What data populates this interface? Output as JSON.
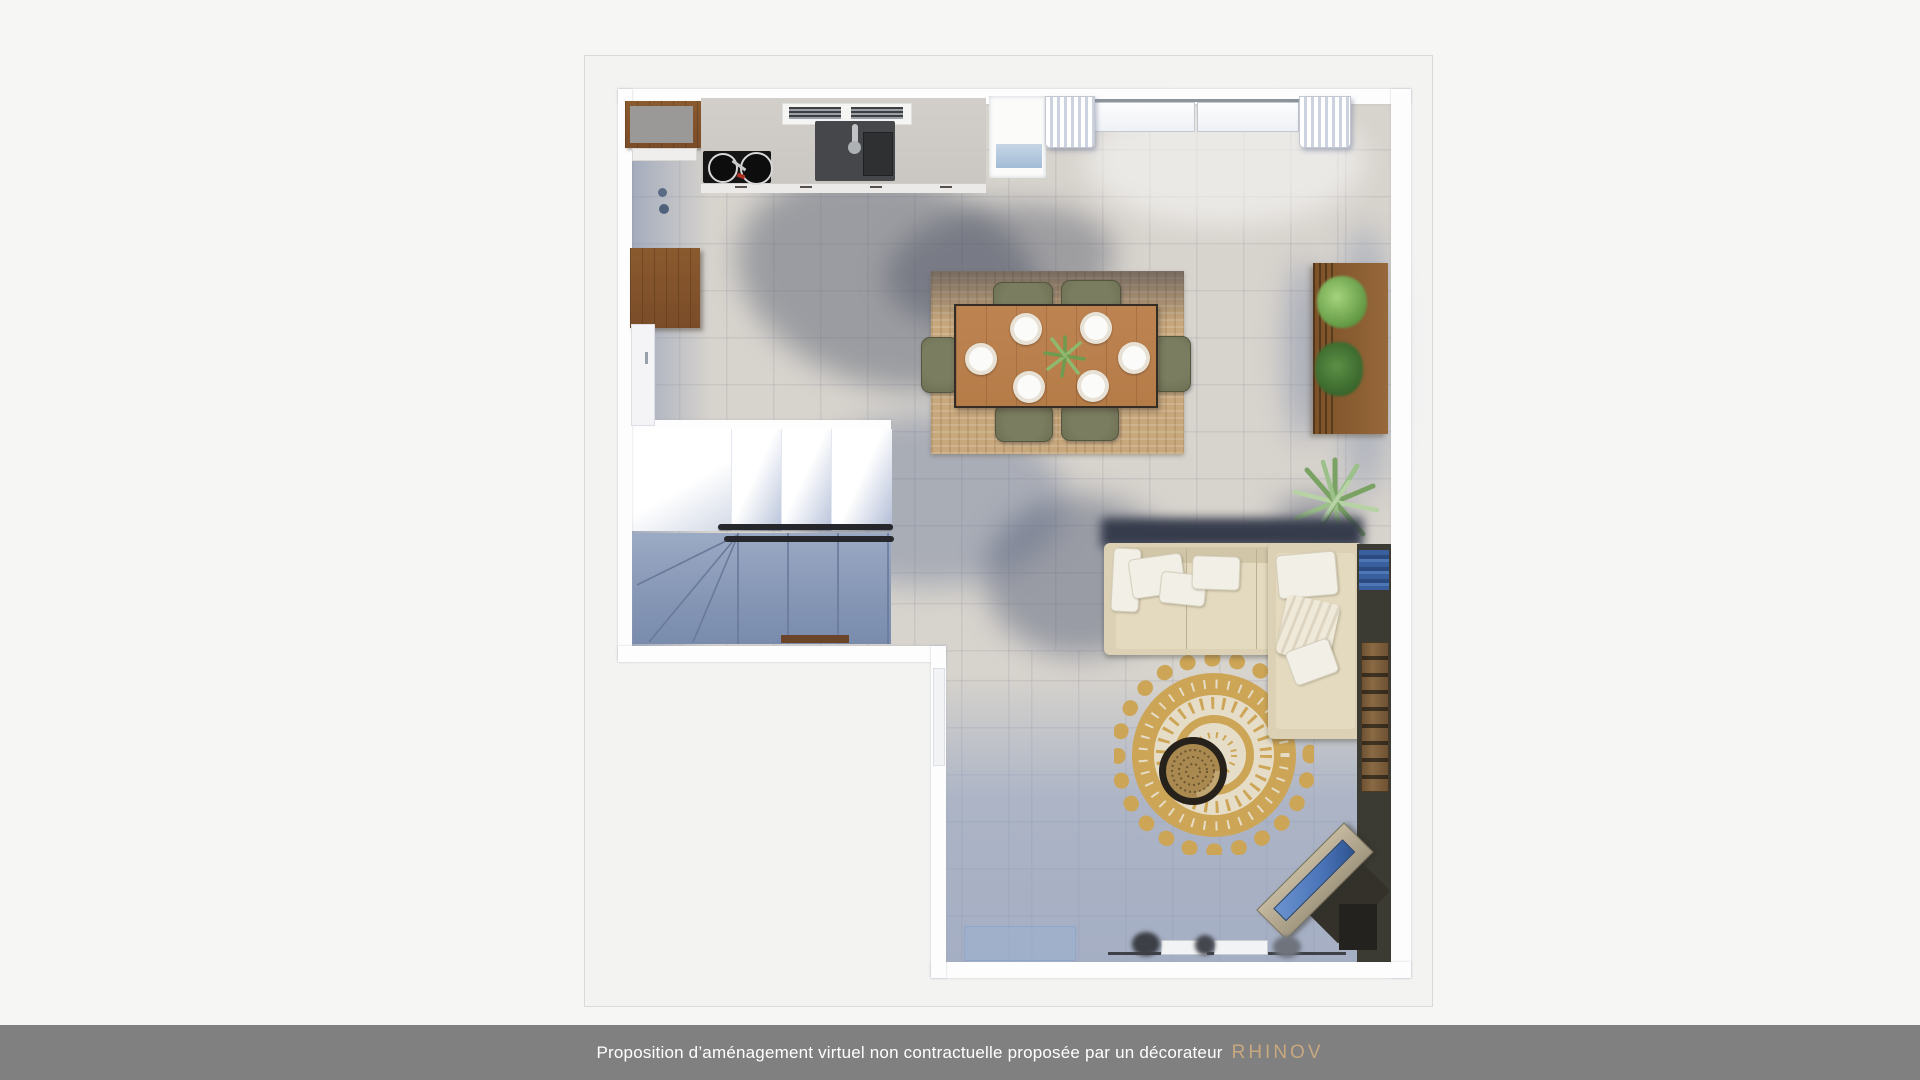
{
  "footer": {
    "text": "Proposition d’aménagement virtuel non contractuelle proposée par un décorateur",
    "brand": "RHINOV"
  },
  "palette": {
    "c-page": "#f6f6f5",
    "c-bar": "#808080",
    "c-bar-text": "#ffffff",
    "c-brand": "#c8a87e",
    "c-frame": "#f3f3f2",
    "c-frame-border": "#d9d9d7",
    "c-wall": "#fdfdfd",
    "c-floor": "#d7d3cd",
    "c-floor-shadow": "#8394b4",
    "c-wood": "#7a4c28",
    "c-wood-light": "#96683a",
    "c-counter": "#cac7c3",
    "c-counter-gray": "#9b9998",
    "c-cooktop": "#151515",
    "c-sink": "#45474a",
    "c-table-wood": "#b67c48",
    "c-chair": "#6e7053",
    "c-jute": "#c7a77c",
    "c-sofa": "#dcd1b5",
    "c-sofa-seat": "#e4dabf",
    "c-pillow": "#f2efe6",
    "c-rug-gold": "#cda556",
    "c-rug-cream": "#e6ddc8",
    "c-coffee-table": "#26211b",
    "c-accent-dark": "#3b3b33",
    "c-tv-blue": "#4a74b8",
    "c-mat-blue": "#a3bcd6",
    "c-plant": "#76a263",
    "c-plant-light": "#9cc08a",
    "c-plant-dark": "#4e7f3f",
    "c-rail": "#26272c",
    "c-threshold": "#6b4529"
  }
}
